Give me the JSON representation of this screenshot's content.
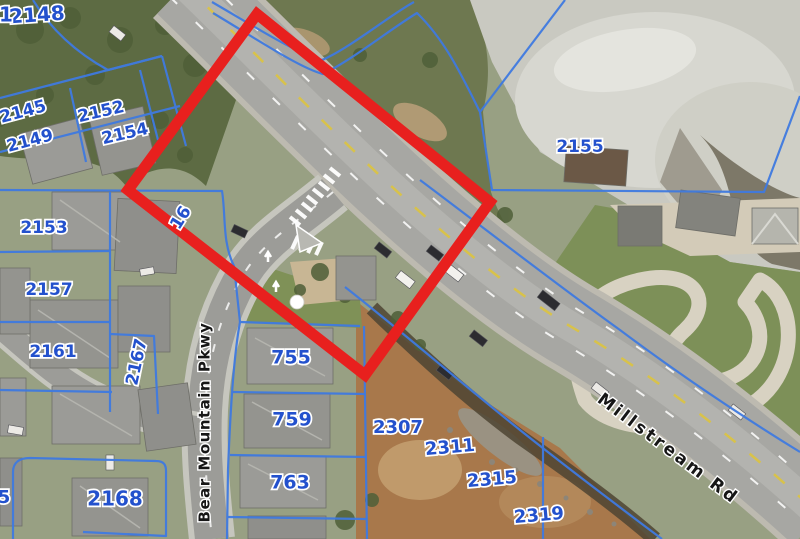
{
  "figure": {
    "kind": "aerial-parcel-map",
    "width": 800,
    "height": 539
  },
  "map": {
    "road_labels": [
      {
        "text": "Bear Mountain Pkwy",
        "x": 205,
        "y": 422,
        "rotation": -90,
        "size": 15,
        "spacing": 1.5
      },
      {
        "text": "Millstream Rd",
        "x": 668,
        "y": 449,
        "rotation": 37,
        "size": 17,
        "spacing": 3
      }
    ],
    "parcel_labels": [
      {
        "text": "2148",
        "x": 37,
        "y": 16,
        "rotation": -4,
        "size": 20
      },
      {
        "text": "2145",
        "x": 23,
        "y": 112,
        "rotation": -15,
        "size": 17
      },
      {
        "text": "2149",
        "x": 30,
        "y": 141,
        "rotation": -15,
        "size": 17
      },
      {
        "text": "2152",
        "x": 101,
        "y": 112,
        "rotation": -13,
        "size": 17
      },
      {
        "text": "2154",
        "x": 125,
        "y": 134,
        "rotation": -13,
        "size": 17
      },
      {
        "text": "2153",
        "x": 44,
        "y": 228,
        "rotation": 0,
        "size": 17
      },
      {
        "text": "2157",
        "x": 49,
        "y": 290,
        "rotation": 0,
        "size": 17
      },
      {
        "text": "2161",
        "x": 53,
        "y": 352,
        "rotation": 0,
        "size": 17
      },
      {
        "text": "2167",
        "x": 137,
        "y": 362,
        "rotation": -78,
        "size": 17
      },
      {
        "text": "2155",
        "x": 580,
        "y": 147,
        "rotation": 0,
        "size": 17
      },
      {
        "text": "2168",
        "x": 115,
        "y": 500,
        "rotation": 0,
        "size": 20
      },
      {
        "text": "755",
        "x": 291,
        "y": 358,
        "rotation": 0,
        "size": 19
      },
      {
        "text": "759",
        "x": 292,
        "y": 420,
        "rotation": 0,
        "size": 19
      },
      {
        "text": "763",
        "x": 290,
        "y": 483,
        "rotation": 0,
        "size": 19
      },
      {
        "text": "2307",
        "x": 398,
        "y": 428,
        "rotation": 0,
        "size": 18
      },
      {
        "text": "2311",
        "x": 450,
        "y": 448,
        "rotation": -5,
        "size": 18
      },
      {
        "text": "2315",
        "x": 492,
        "y": 480,
        "rotation": -5,
        "size": 18
      },
      {
        "text": "2319",
        "x": 539,
        "y": 516,
        "rotation": -5,
        "size": 18
      }
    ],
    "partial_labels": [
      {
        "text": "1",
        "x": 6,
        "y": 16,
        "rotation": 0,
        "size": 20
      },
      {
        "text": "16",
        "x": 181,
        "y": 218,
        "rotation": -58,
        "size": 17
      },
      {
        "text": "5",
        "x": 4,
        "y": 498,
        "rotation": 0,
        "size": 18
      }
    ],
    "highlight_box": {
      "color": "#e8201e",
      "stroke_width": 11,
      "corners": [
        [
          257,
          14
        ],
        [
          490,
          202
        ],
        [
          365,
          375
        ],
        [
          128,
          190
        ]
      ]
    },
    "survey_marker": {
      "x": 297,
      "y": 302,
      "radius": 7,
      "color": "#ffffff"
    },
    "colors": {
      "parcel_line": "#3f7ae0",
      "parcel_text": "#2351cd",
      "road_text": "#161616",
      "label_halo": "#ffffff"
    }
  }
}
